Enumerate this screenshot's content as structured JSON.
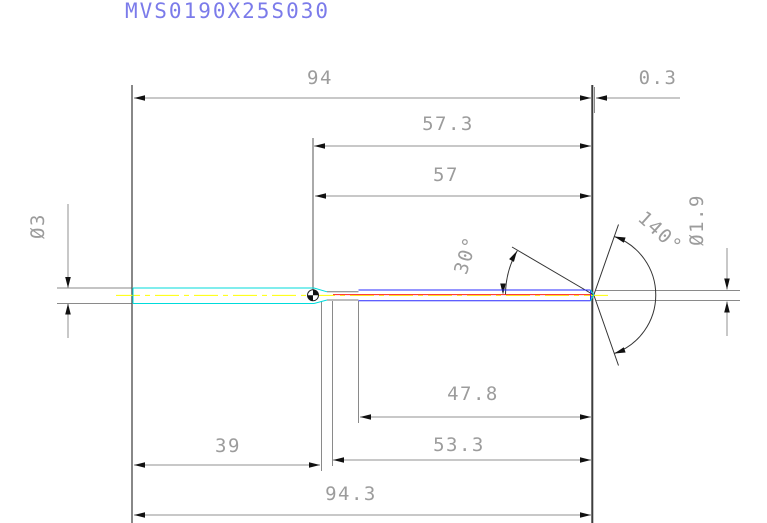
{
  "title": "MVS0190X25S030",
  "dims": {
    "d94": "94",
    "d0_3": "0.3",
    "d57_3": "57.3",
    "d57": "57",
    "d47_8": "47.8",
    "d53_3": "53.3",
    "d39": "39",
    "d94_3": "94.3",
    "shank_dia": "Ø3",
    "tip_dia": "Ø1.9",
    "a30": "30°",
    "a140": "140°"
  },
  "colors": {
    "title_text": "#7b7bea",
    "dimension_text": "#9c9c9c",
    "dimension_line": "#909090",
    "arrow_fill": "#111111",
    "shank_outline": "#00dbdb",
    "centerline": "#ffff00",
    "flute_outline": "#2929ff",
    "flute_core_line": "#ff2020",
    "neck_outline": "#787878",
    "geometry_line": "#333333",
    "background": "#ffffff"
  }
}
